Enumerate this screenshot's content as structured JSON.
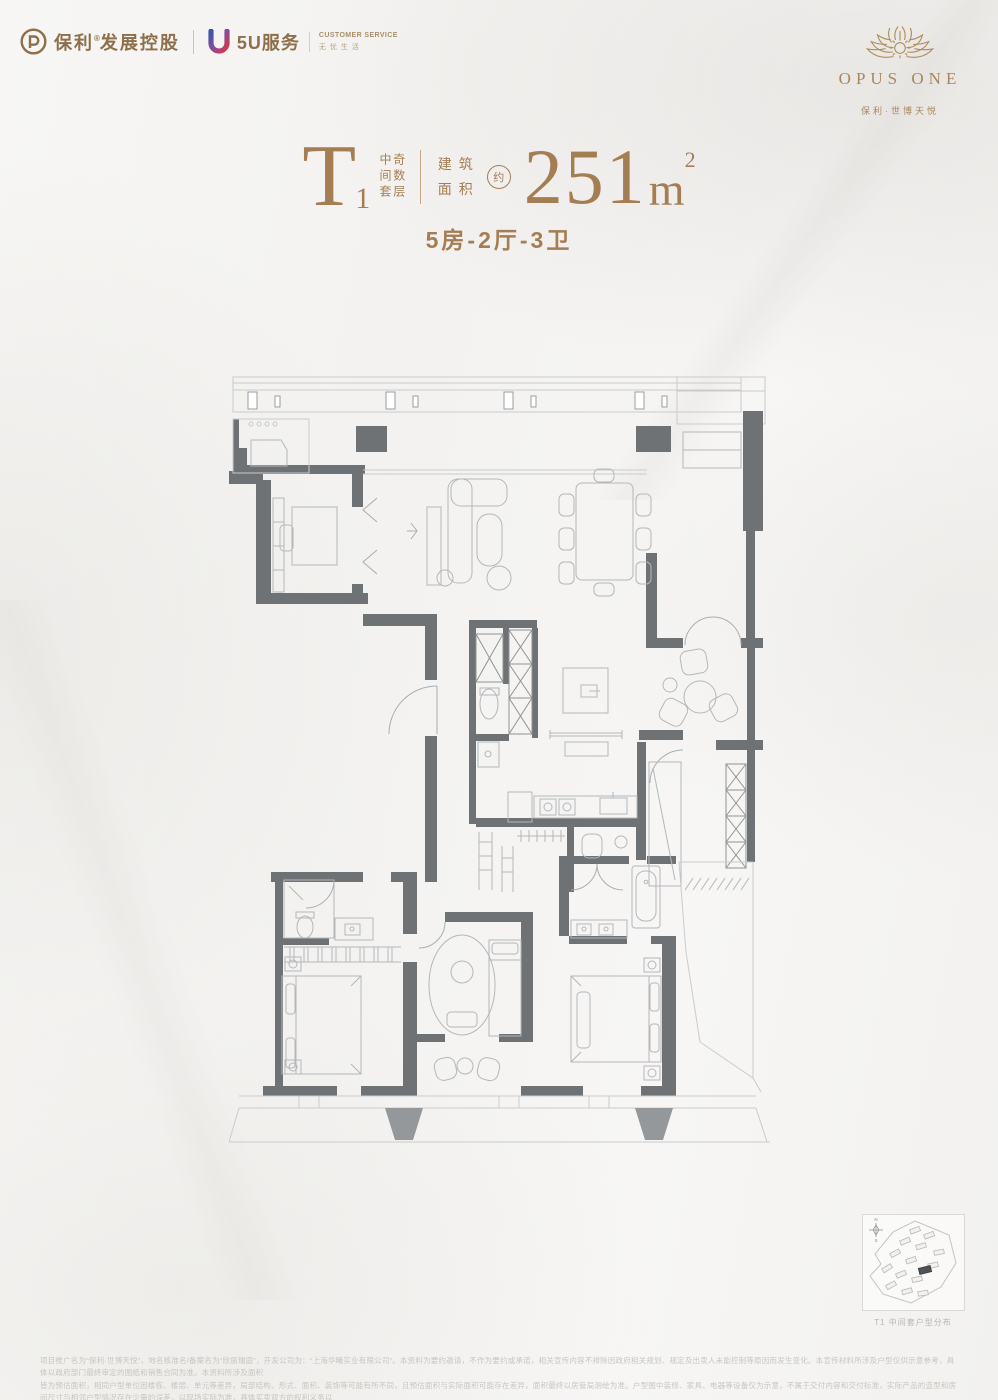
{
  "colors": {
    "accent_gold": "#a57d52",
    "brand_brown": "#8d6f49",
    "emblem_gold": "#b08d57",
    "wall_gray": "#6f7274",
    "furniture_line": "#b4b7ba",
    "disclaimer_gray": "#c9c5c0"
  },
  "header_left": {
    "poly_name": "保利",
    "poly_reg": "®",
    "poly_suffix": "发展控股",
    "service_brand": "5U服务",
    "service_en": "CUSTOMER SERVICE",
    "service_cn": "无忧生活"
  },
  "header_right": {
    "wordmark": "OPUS ONE",
    "project": "保利·世博天悦"
  },
  "unit": {
    "model": "T",
    "model_index": "1",
    "tag_col_1": "中间套",
    "tag_col_2": "奇数层",
    "area_label_1": "建筑",
    "area_label_2": "面积",
    "approx": "约",
    "area_value": "251",
    "area_unit": "m",
    "area_sup": "2",
    "layout": "5房-2厅-3卫"
  },
  "site_plan": {
    "caption": "T1 中间套户型分布",
    "compass_n": "N",
    "compass_s": "S"
  },
  "disclaimer": {
    "line1": "项目推广名为“保利·世博天悦”，地名核准名/备案名为“欣丽瑞庭”，开发公司为：“上海华曦实业有限公司”。本资料为要约邀请，不作为要约或承诺，相关宣传内容不排除因政府相关规划、规定及出卖人未能控制等原因而发生变化。本宣传材料所涉及户型仅供示意参考，具体以政府部门最终审定的图纸和销售合同为准。本资料所涉及面积",
    "line2": "皆为预估面积，相同户型单位因楼栋、楼层、单元等差异，局部结构、形式、面积、装饰等可能有所不同，且预估面积与实际面积可能存在差异，面积最终以房管局测绘为准。户型图中装修、家具、电器等设备仅为示意，不属于交付内容和交付标准，实际产品的造型和房间尺寸与相邻户型情况存在少量的误差，以现场实际为准，具体买卖双方的权利义务以",
    "line3": "双方签订的《商品房买卖合同》及其补充协议、附件等书面文件为准。本资料所发布内容为2024年3月31日前的信息，于2024年4月印刷，敬请留意。"
  }
}
